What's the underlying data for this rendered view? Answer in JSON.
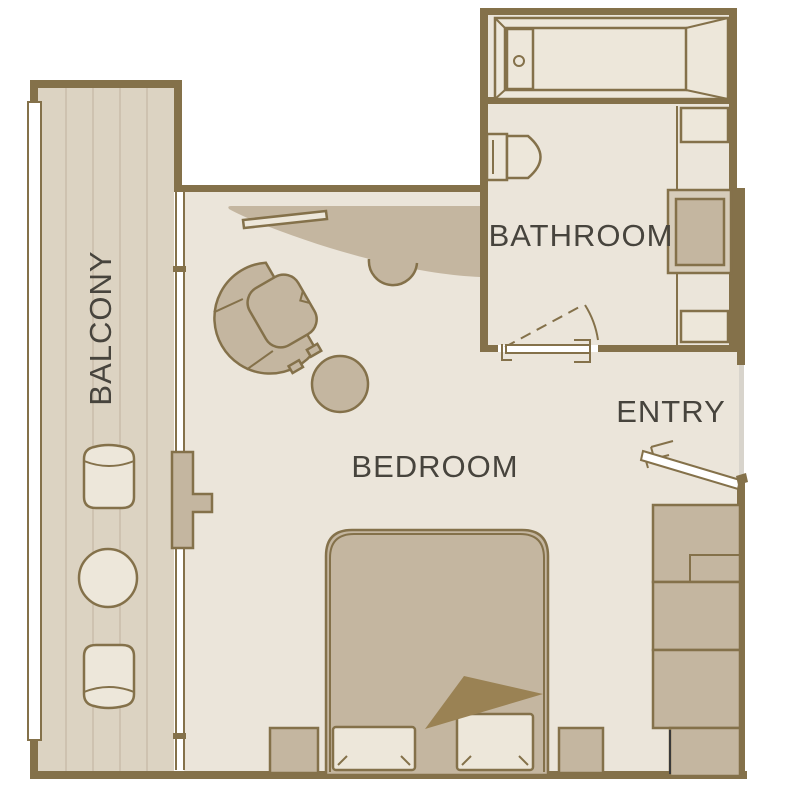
{
  "floorplan": {
    "title": "Stateroom floor plan",
    "rooms": {
      "balcony": {
        "label": "BALCONY"
      },
      "bathroom": {
        "label": "BATHROOM"
      },
      "bedroom": {
        "label": "BEDROOM"
      },
      "entry": {
        "label": "ENTRY"
      }
    },
    "furniture_icons": [
      "bathtub-icon",
      "toilet-icon",
      "vanity-sink-icon",
      "bathroom-sliding-door-icon",
      "entry-door-icon",
      "wardrobe-icon",
      "bed-icon",
      "pillow-icon",
      "blanket-fold-icon",
      "nightstand-icon",
      "armchair-icon",
      "ottoman-icon",
      "desk-icon",
      "stool-icon",
      "shelf-icon",
      "balcony-chair-icon",
      "balcony-table-icon",
      "balcony-railing-icon"
    ],
    "colors": {
      "background": "#FFFFFF",
      "wall": "#84714A",
      "floor": "#EBE5DA",
      "deck": "#DCD3C2",
      "deck_line": "#C9BDA9",
      "furniture": "#C4B6A0",
      "furniture_light": "#EDE7DA",
      "frame_light": "#D6CCBA",
      "blanket": "#9A8254",
      "doorway": "#D8D4CC",
      "label_text": "#47443D",
      "dark_edge": "#3A3A3A",
      "door_white": "#FFFFFF"
    }
  }
}
